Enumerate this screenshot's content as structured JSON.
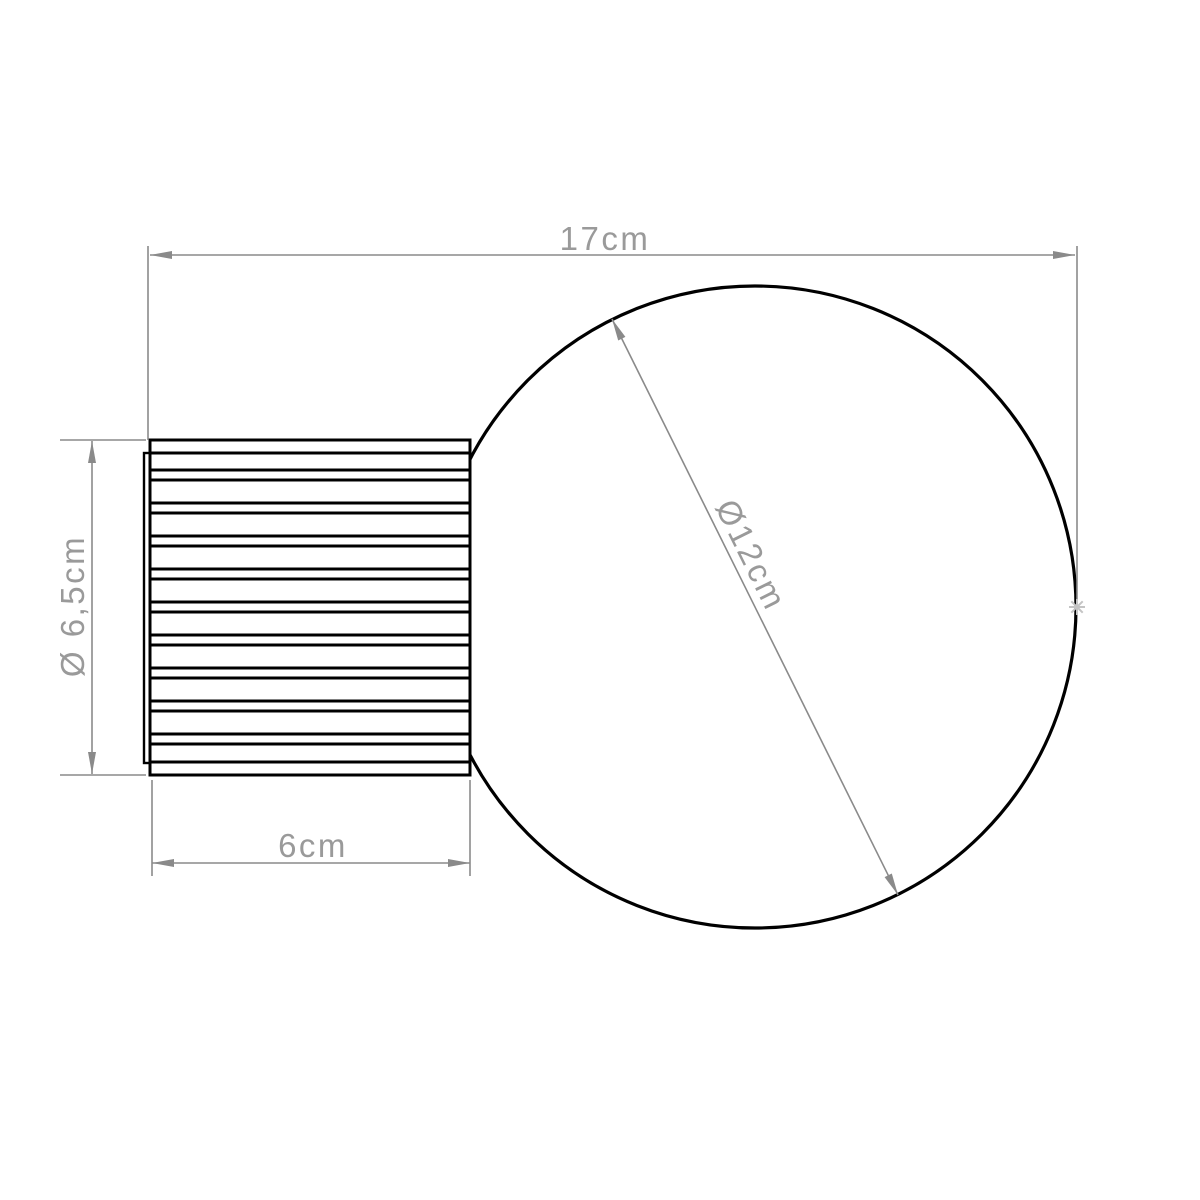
{
  "page": {
    "background": "#ffffff"
  },
  "colors": {
    "outline": "#000000",
    "dimension_line": "#8a8a8a",
    "label_text": "#9a9a9a",
    "marker": "#c4c4c4"
  },
  "labels": {
    "total_width": "17cm",
    "globe_diameter": "Ø12cm",
    "base_height": "Ø 6,5cm",
    "base_width": "6cm"
  }
}
